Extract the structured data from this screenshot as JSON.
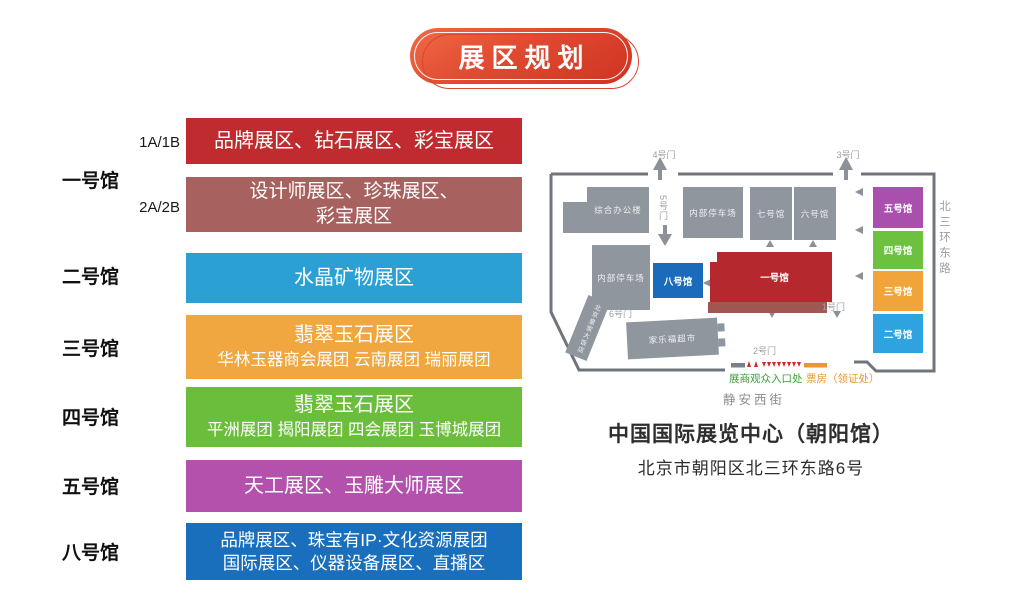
{
  "title": {
    "text": "展区规划"
  },
  "legend": {
    "sub_labels": [
      "1A/1B",
      "2A/2B"
    ],
    "hall_labels": [
      "一号馆",
      "二号馆",
      "三号馆",
      "四号馆",
      "五号馆",
      "八号馆"
    ],
    "bars": [
      {
        "line1": "品牌展区、钻石展区、彩宝展区"
      },
      {
        "line1": "设计师展区、珍珠展区、",
        "line2": "彩宝展区"
      },
      {
        "line1": "水晶矿物展区"
      },
      {
        "line1": "翡翠玉石展区",
        "line2": "华林玉器商会展团 云南展团 瑞丽展团"
      },
      {
        "line1": "翡翠玉石展区",
        "line2": "平洲展团 揭阳展团 四会展团 玉博城展团"
      },
      {
        "line1": "天工展区、玉雕大师展区"
      },
      {
        "line1": "品牌展区、珠宝有IP·文化资源展团",
        "line2": "国际展区、仪器设备展区、直播区"
      }
    ]
  },
  "map": {
    "gates": {
      "g1": "1号门",
      "g2": "2号门",
      "g3": "3号门",
      "g4": "4号门",
      "g5": "5号门",
      "g6": "6号门"
    },
    "blocks": {
      "office": "综合办公楼",
      "parking_a": "内部停车场",
      "parking_b": "内部停车场",
      "hall7": "七号馆",
      "hall6": "六号馆",
      "hall8": "八号馆",
      "hall1": "一号馆",
      "hall5": "五号馆",
      "hall4": "四号馆",
      "hall3": "三号馆",
      "hall2": "二号馆",
      "supermarket": "家乐福超市",
      "hotel": "北京皇家大饭店"
    },
    "road": "北三环东路",
    "street": "静安西街",
    "entrance": "展商观众入口处",
    "ticket": "票房（领证处）"
  },
  "venue": {
    "name": "中国国际展览中心（朝阳馆）",
    "address": "北京市朝阳区北三环东路6号"
  },
  "colors": {
    "banner_red": "#e04a31",
    "bar_red": "#bf2b2e",
    "bar_maroon": "#a76260",
    "bar_blue": "#2aa0d5",
    "bar_orange": "#f0a73f",
    "bar_green": "#6bbe3b",
    "bar_purple": "#b351ad",
    "bar_deep_blue": "#1a6fbd",
    "map_gray": "#8f969d",
    "map_hall1_red": "#b5292e",
    "map_hall8_blue": "#1b6bbd",
    "map_hall5_purple": "#a94fae",
    "map_hall4_green": "#6cc23f",
    "map_hall3_orange": "#f0a43a",
    "map_hall2_blue": "#2fa3df",
    "entrance_green": "#39a13a",
    "ticket_orange": "#e8982e"
  }
}
